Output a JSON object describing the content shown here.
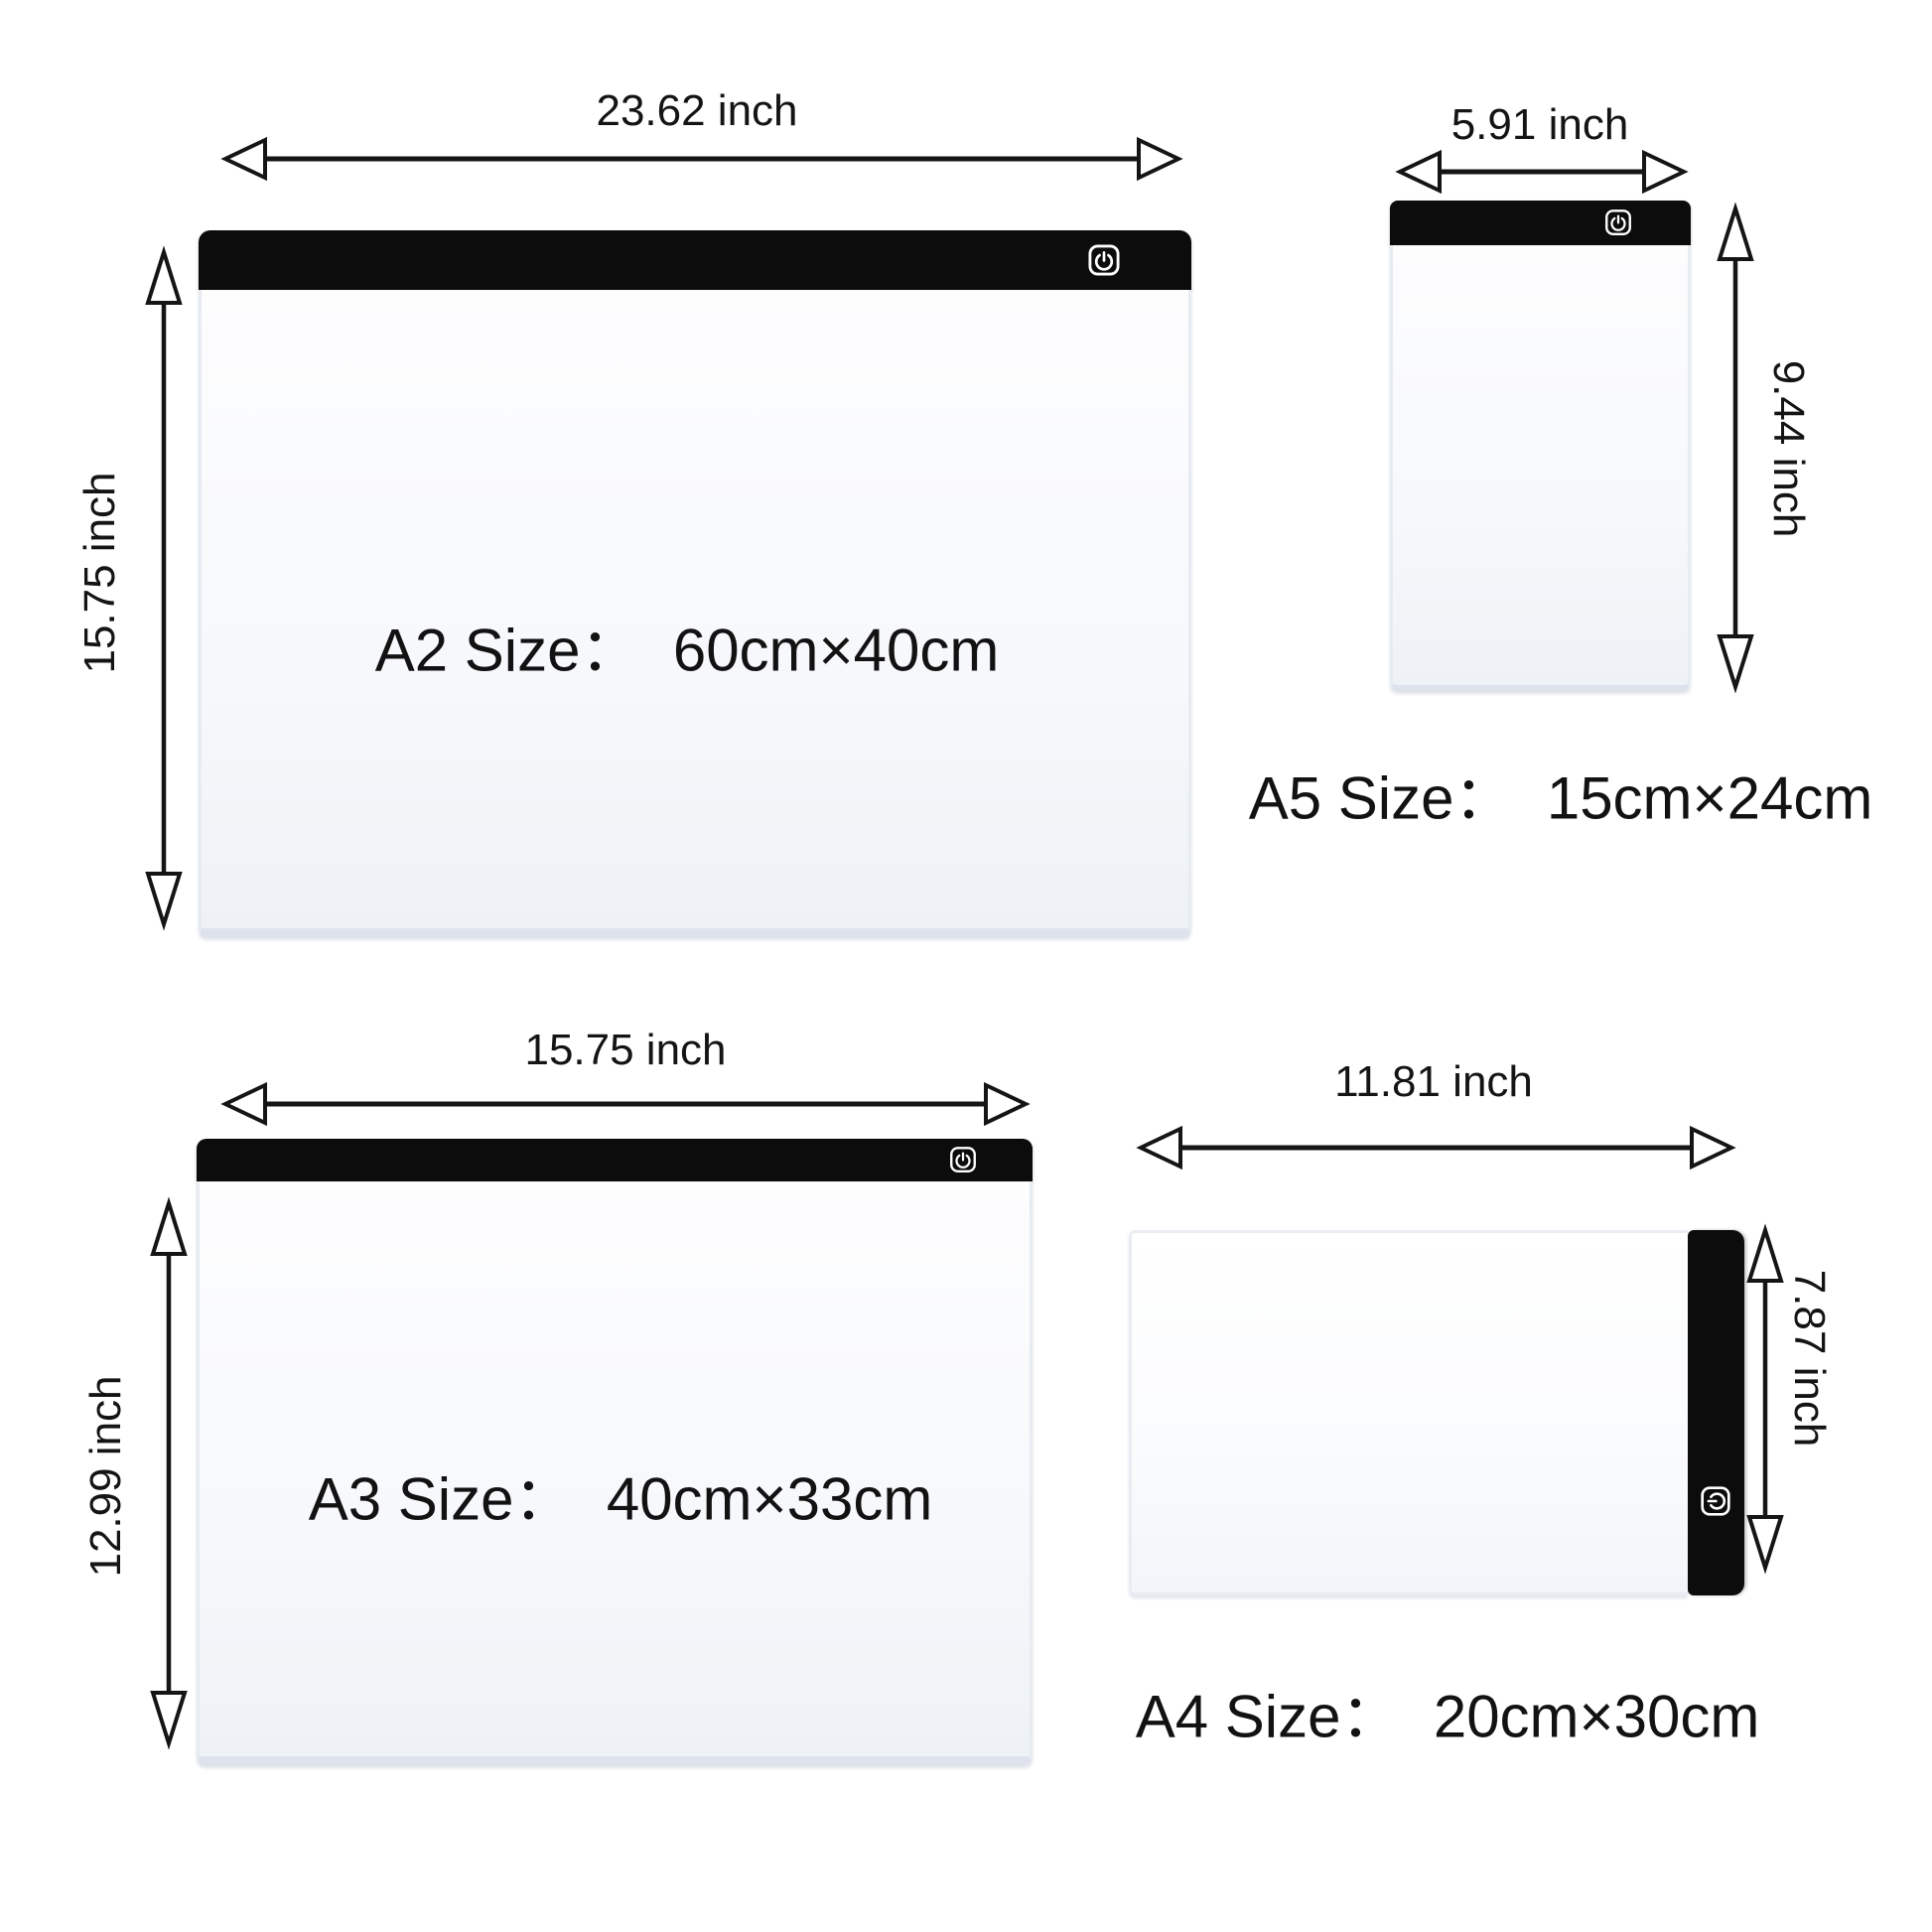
{
  "colors": {
    "background": "#ffffff",
    "pad_bar": "#0c0c0c",
    "arrow_ink": "#151515",
    "pad_body_light": "#f6f8fb"
  },
  "products": {
    "a2": {
      "size_label": "A2 Size：  60cm×40cm",
      "width_inches": "23.62 inch",
      "height_inches": "15.75 inch"
    },
    "a5": {
      "size_label": "A5 Size：  15cm×24cm",
      "width_inches": "5.91 inch",
      "height_inches": "9.44 inch"
    },
    "a3": {
      "size_label": "A3 Size：  40cm×33cm",
      "width_inches": "15.75 inch",
      "height_inches": "12.99 inch"
    },
    "a4": {
      "size_label": "A4 Size：  20cm×30cm",
      "width_inches": "11.81 inch",
      "height_inches": "7.87 inch"
    }
  },
  "icons": {
    "power": "power-button"
  }
}
